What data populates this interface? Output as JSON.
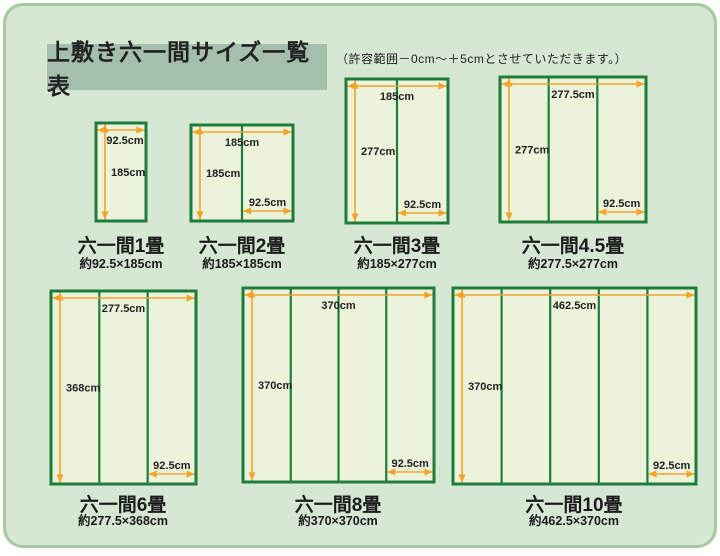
{
  "header": {
    "title": "上敷き六一間サイズ一覧表",
    "note": "（許容範囲－0cm～＋5cmとさせていただきます。）"
  },
  "colors": {
    "page_bg": "#ffffff",
    "panel_bg": "#d6e7d4",
    "panel_border": "#a9c7a4",
    "title_box_bg": "#a4bfab",
    "mat_fill": "#ebf3da",
    "mat_border": "#1f7c3a",
    "arrow": "#f2a42c",
    "label_text": "#1f1f1f"
  },
  "diagrams": [
    {
      "name": "六一間1畳",
      "size": "約92.5×185cm",
      "panels": 1,
      "width_label": "92.5cm",
      "height_label": "185cm",
      "panel_label": ""
    },
    {
      "name": "六一間2畳",
      "size": "約185×185cm",
      "panels": 2,
      "width_label": "185cm",
      "height_label": "185cm",
      "panel_label": "92.5cm"
    },
    {
      "name": "六一間3畳",
      "size": "約185×277cm",
      "panels": 2,
      "width_label": "185cm",
      "height_label": "277cm",
      "panel_label": "92.5cm"
    },
    {
      "name": "六一間4.5畳",
      "size": "約277.5×277cm",
      "panels": 3,
      "width_label": "277.5cm",
      "height_label": "277cm",
      "panel_label": "92.5cm"
    },
    {
      "name": "六一間6畳",
      "size": "約277.5×368cm",
      "panels": 3,
      "width_label": "277.5cm",
      "height_label": "368cm",
      "panel_label": "92.5cm"
    },
    {
      "name": "六一間8畳",
      "size": "約370×370cm",
      "panels": 4,
      "width_label": "370cm",
      "height_label": "370cm",
      "panel_label": "92.5cm"
    },
    {
      "name": "六一間10畳",
      "size": "約462.5×370cm",
      "panels": 5,
      "width_label": "462.5cm",
      "height_label": "370cm",
      "panel_label": "92.5cm"
    }
  ]
}
